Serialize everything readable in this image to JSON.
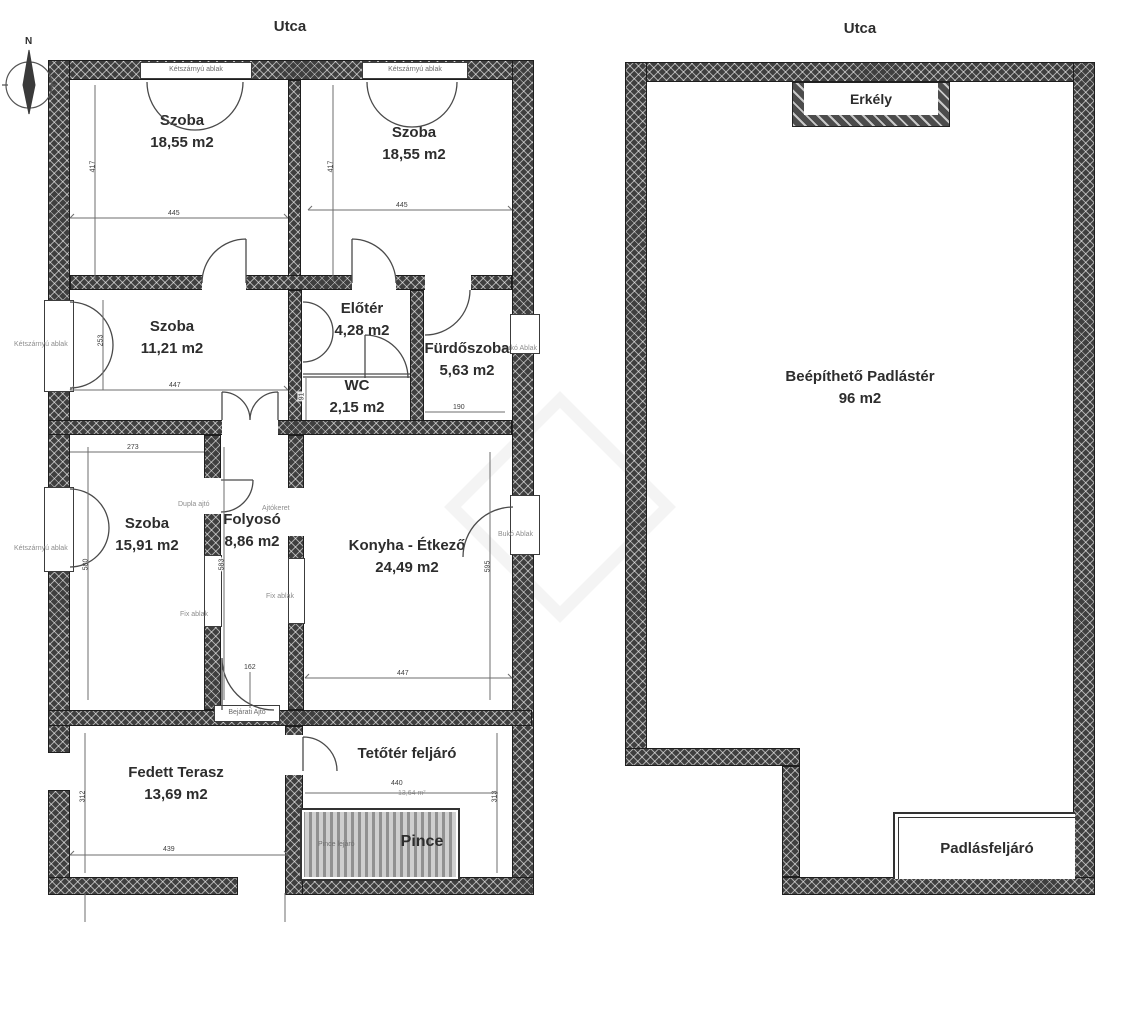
{
  "compass": {
    "north": "N"
  },
  "left_plan": {
    "street": "Utca",
    "rooms": {
      "szoba1": {
        "name": "Szoba",
        "area": "18,55 m2"
      },
      "szoba2": {
        "name": "Szoba",
        "area": "18,55 m2"
      },
      "szoba3": {
        "name": "Szoba",
        "area": "11,21 m2"
      },
      "eloter": {
        "name": "Előtér",
        "area": "4,28 m2"
      },
      "furdoszoba": {
        "name": "Fürdőszoba",
        "area": "5,63 m2"
      },
      "wc": {
        "name": "WC",
        "area": "2,15 m2"
      },
      "szoba4": {
        "name": "Szoba",
        "area": "15,91 m2"
      },
      "folyoso": {
        "name": "Folyosó",
        "area": "8,86 m2"
      },
      "konyha": {
        "name": "Konyha - Étkező",
        "area": "24,49 m2"
      },
      "terasz": {
        "name": "Fedett Terasz",
        "area": "13,69 m2"
      },
      "tetoter": {
        "name": "Tetőtér feljáró",
        "area": "13,64 m²"
      },
      "pince": {
        "name": "Pince"
      }
    },
    "wall_labels": {
      "window_top_left": "Kétszárnyú ablak",
      "window_top_right": "Kétszárnyú ablak",
      "window_szoba3": "Kétszárnyú ablak",
      "window_szoba4": "Kétszárnyú ablak",
      "window_furdo": "Bukó Ablak",
      "window_konyha": "Bukó Ablak",
      "door_frame": "Ajtókeret",
      "fix_window_1": "Fix ablak",
      "fix_window_2": "Fix ablak",
      "double_door": "Dupla ajtó",
      "entry_door": "Bejárati Ajtó",
      "cellar_stairs": "Pince lejáró"
    },
    "dimensions": {
      "szoba1_w": "445",
      "szoba2_w": "445",
      "szoba1_h": "417",
      "szoba2_h": "417",
      "szoba3_w": "447",
      "szoba3_win": "253",
      "wc_h": "91",
      "furdo_w": "190",
      "szoba4_top": "273",
      "szoba4_h": "580",
      "folyoso_h": "583",
      "konyha_h": "595",
      "konyha_w": "447",
      "folyoso_door": "162",
      "terasz_h": "312",
      "terasz_w": "439",
      "tetoter_w": "440",
      "tetoter_h": "313"
    }
  },
  "right_plan": {
    "street": "Utca",
    "rooms": {
      "padlaster": {
        "name": "Beépíthető Padlástér",
        "area": "96 m2"
      },
      "erkely": {
        "name": "Erkély"
      },
      "padlasfeljaro": {
        "name": "Padlásfeljáró"
      }
    }
  }
}
